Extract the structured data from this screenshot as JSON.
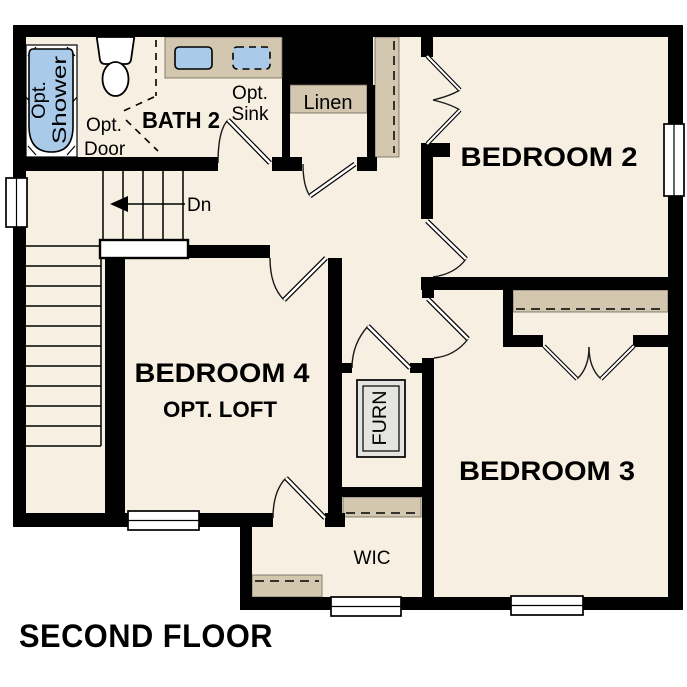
{
  "floor_title": "SECOND FLOOR",
  "colors": {
    "background": "#ffffff",
    "floor": "#f7efe1",
    "wall": "#000000",
    "casework_tan": "#d3c8af",
    "fixture_blue": "#a9cae9",
    "furnace_gray": "#e4e4e0"
  },
  "labels": {
    "bath": "BATH 2",
    "opt_sink": [
      "Opt.",
      "Sink"
    ],
    "opt_door": [
      "Opt.",
      "Door"
    ],
    "opt_shower": [
      "Opt.",
      "Shower"
    ],
    "linen": "Linen",
    "bedroom2": "BEDROOM 2",
    "bedroom3": "BEDROOM 3",
    "bedroom4": "BEDROOM 4",
    "bedroom4_sub": "OPT. LOFT",
    "wic": "WIC",
    "furnace": "FURN",
    "stairs_down": "Dn"
  }
}
